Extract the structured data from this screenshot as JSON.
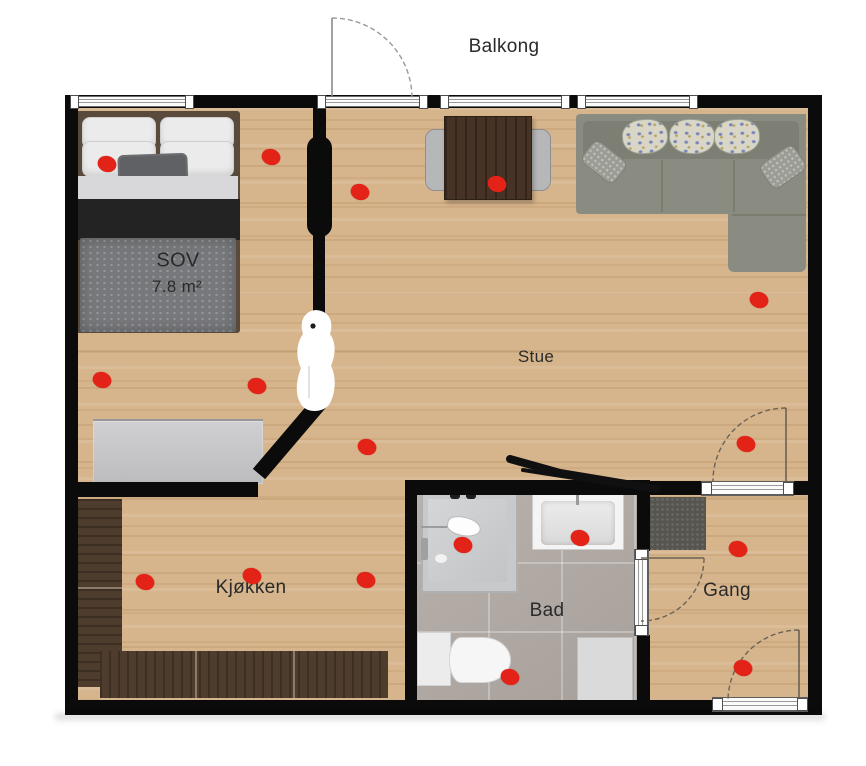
{
  "canvas": {
    "width": 866,
    "height": 766,
    "background": "#ffffff"
  },
  "plan": {
    "type": "apartment-floorplan",
    "labels": [
      {
        "id": "balkong",
        "text": "Balkong",
        "x": 504,
        "y": 47,
        "size": 19
      },
      {
        "id": "sov",
        "text": "SOV",
        "x": 178,
        "y": 261,
        "size": 20
      },
      {
        "id": "sov-area",
        "text": "7.8 m²",
        "x": 177,
        "y": 287,
        "size": 17
      },
      {
        "id": "stue",
        "text": "Stue",
        "x": 536,
        "y": 357,
        "size": 17
      },
      {
        "id": "kjokken",
        "text": "Kjøkken",
        "x": 251,
        "y": 588,
        "size": 19
      },
      {
        "id": "bad",
        "text": "Bad",
        "x": 547,
        "y": 611,
        "size": 19
      },
      {
        "id": "gang",
        "text": "Gang",
        "x": 727,
        "y": 591,
        "size": 19
      }
    ],
    "markers": {
      "color": "#e42318",
      "diameter": 19,
      "points": [
        {
          "x": 107,
          "y": 164
        },
        {
          "x": 271,
          "y": 157
        },
        {
          "x": 102,
          "y": 380
        },
        {
          "x": 257,
          "y": 386
        },
        {
          "x": 360,
          "y": 192
        },
        {
          "x": 497,
          "y": 184
        },
        {
          "x": 759,
          "y": 300
        },
        {
          "x": 367,
          "y": 447
        },
        {
          "x": 746,
          "y": 444
        },
        {
          "x": 145,
          "y": 582
        },
        {
          "x": 252,
          "y": 576
        },
        {
          "x": 366,
          "y": 580
        },
        {
          "x": 463,
          "y": 545
        },
        {
          "x": 580,
          "y": 538
        },
        {
          "x": 510,
          "y": 677
        },
        {
          "x": 738,
          "y": 549
        },
        {
          "x": 743,
          "y": 668
        }
      ]
    },
    "colors": {
      "wall": "#0b0b0b",
      "wood_floor": "#d7b58c",
      "bath_floor": "#b2aaa4",
      "kitchen_cabinet": "#4e3c2d",
      "sofa": "#8a8c82",
      "marker_red": "#e42318"
    }
  }
}
